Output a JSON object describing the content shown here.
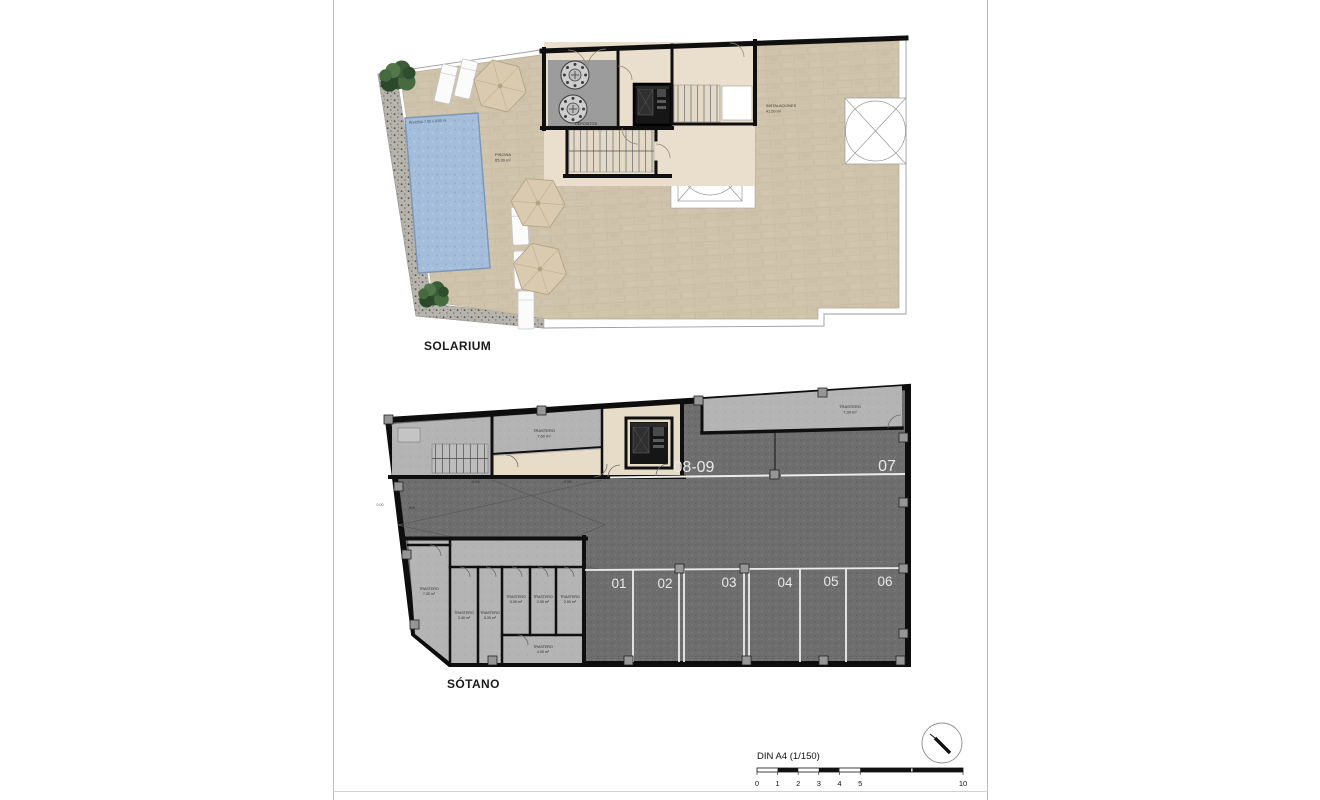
{
  "titles": {
    "solarium": "SOLARIUM",
    "sotano": "SÓTANO"
  },
  "solarium": {
    "pool_dim": "PISCINA 7.00 x 3.00 m.",
    "pool_name": "PISCINA",
    "pool_area": "65.30 m²",
    "depositos": "DEPOSITOS",
    "instalaciones_name": "INSTALACIONES",
    "instalaciones_area": "41.59 m²"
  },
  "sotano": {
    "levels": {
      "l1": "-0.05",
      "l2": "-0.05",
      "street": "0.00",
      "slope": "6%"
    },
    "parking": {
      "p01": "01",
      "p02": "02",
      "p03": "03",
      "p04": "04",
      "p05": "05",
      "p06": "06",
      "p07": "07",
      "p0809": "08-09"
    },
    "trasteros": {
      "t760": {
        "name": "TRASTERO",
        "area": "7.60 m²"
      },
      "t730_right": {
        "name": "TRASTERO",
        "area": "7.30 m²"
      },
      "t730_left": {
        "name": "TRASTERO",
        "area": "7.30 m²"
      },
      "t340": {
        "name": "TRASTERO",
        "area": "3.40 m²"
      },
      "t530": {
        "name": "TRASTERO",
        "area": "5.30 m²"
      },
      "t305": {
        "name": "TRASTERO",
        "area": "3.05 m²"
      },
      "t295": {
        "name": "TRASTERO",
        "area": "2.95 m²"
      },
      "t290": {
        "name": "TRASTERO",
        "area": "2.90 m²"
      },
      "t405": {
        "name": "TRASTERO",
        "area": "4.05 m²"
      }
    }
  },
  "footer": {
    "scale_label": "DIN A4 (1/150)",
    "ticks": {
      "t0": "0",
      "t1": "1",
      "t2": "2",
      "t3": "3",
      "t4": "4",
      "t5": "5",
      "t10": "10"
    }
  },
  "colors": {
    "beige_tile": "#cfc3ab",
    "pool_blue": "#a3bddb",
    "asphalt_gray": "#6e6e6e",
    "storage_gray": "#b4b4b4",
    "corridor_beige": "#e7dcc8",
    "wall_black": "#0f0f0f",
    "parking_line_white": "#ededed"
  }
}
